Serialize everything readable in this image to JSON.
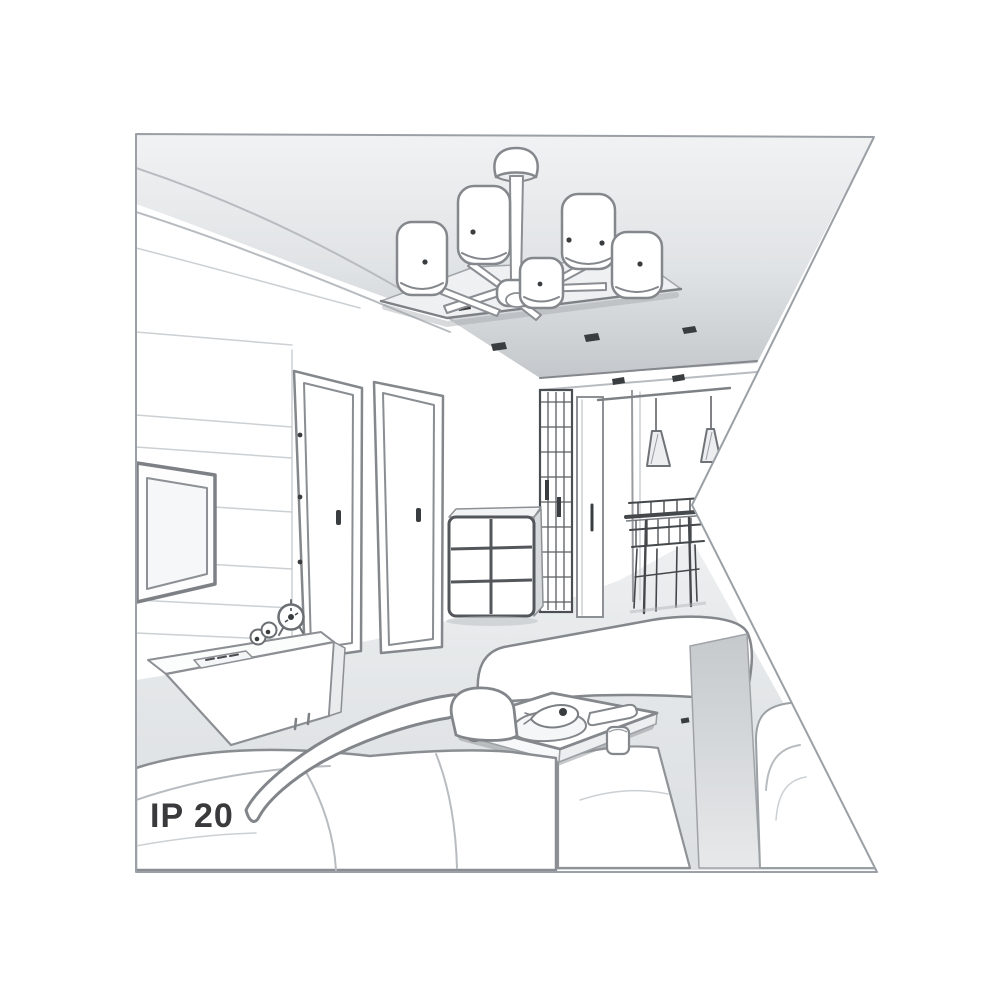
{
  "page": {
    "background_color": "#ffffff"
  },
  "illustration": {
    "protection_rating": "IP 20",
    "style": "grayscale 3D line-art interior rendering clipped to a notched flag shape",
    "scene": "living room with wall TV, sideboard, two doors, hallway wardrobe, dining nook with pendant lamps, sofas, coffee table and a ceiling chandelier",
    "colors": {
      "outline": "#84888c",
      "outline_dark": "#3a3d40",
      "ceiling_shade": "#c7cbcf",
      "floor_shade": "#e2e5e7",
      "label_text": "#3a3a3c",
      "border": "#9aa0a5"
    },
    "objects": [
      "ceiling-chandelier",
      "suspended-ceiling-panel",
      "recessed-spotlights",
      "wall-tv",
      "tv-sideboard",
      "alarm-clock",
      "interior-door-left",
      "interior-door-right",
      "drawer-chest",
      "wardrobe",
      "pendant-lamps",
      "dining-table-with-chairs",
      "corner-sofa",
      "right-sofa",
      "coffee-table",
      "floor"
    ]
  }
}
